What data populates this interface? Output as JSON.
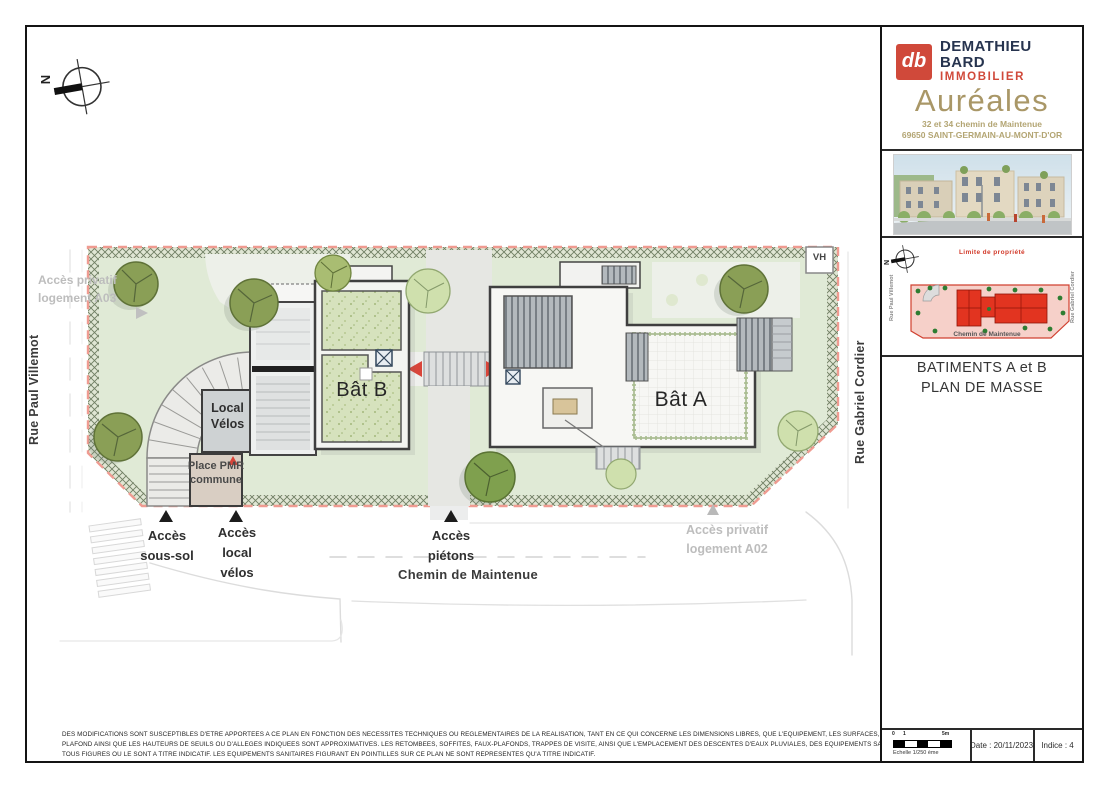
{
  "sidebar": {
    "brand": {
      "logo_glyph": "db",
      "line1": "DEMATHIEU",
      "line2": "BARD",
      "line3": "IMMOBILIER"
    },
    "project": {
      "name": "Auréales",
      "address1": "32 et 34 chemin de Maintenue",
      "address2": "69650 SAINT-GERMAIN-AU-MONT-D'OR"
    },
    "keymap": {
      "limit": "Limite de propriété",
      "north": "N",
      "street_left": "Rue Paul Villemot",
      "street_right": "Rue Gabriel Cordier",
      "street_bottom": "Chemin de Maintenue"
    },
    "title1": "BATIMENTS A et B",
    "title2": "PLAN DE MASSE",
    "footer": {
      "tick0": "0",
      "tick1": "1",
      "tick5": "5m",
      "scale": "Echelle 1/250 ème",
      "date": "Date : 20/11/2023",
      "indice": "Indice : 4"
    }
  },
  "plan": {
    "north": "N",
    "streets": {
      "left": "Rue Paul Villemot",
      "right": "Rue Gabriel Cordier",
      "bottom": "Chemin de Maintenue"
    },
    "buildings": {
      "bat_a": "Bât A",
      "bat_b": "Bât B"
    },
    "rooms": {
      "local_velos": "Local\nVélos",
      "place_pmr": "Place PMR\ncommune"
    },
    "markers": {
      "vh": "VH"
    },
    "access": {
      "sous_sol": "Accès\nsous-sol",
      "local_velos": "Accès\nlocal\nvélos",
      "pietons": "Accès\npiétons",
      "privatif_a02": "Accès privatif\nlogement A02",
      "privatif_a03": "Accès privatif\nlogement A03"
    }
  },
  "notes": {
    "line1": "DES MODIFICATIONS SONT SUSCEPTIBLES D'ETRE APPORTEES A CE PLAN EN FONCTION DES NECESSITES TECHNIQUES OU REGLEMENTAIRES DE LA REALISATION, TANT EN CE QUI CONCERNE LES DIMENSIONS LIBRES, QUE L'EQUIPEMENT, LES SURFACES, LES HAUTEURS SOUS",
    "line2": "PLAFOND AINSI QUE LES HAUTEURS DE SEUILS OU D'ALLEGES INDIQUEES SONT APPROXIMATIVES. LES RETOMBEES, SOFFITES, FAUX-PLAFONDS, TRAPPES DE VISITE, AINSI QUE L'EMPLACEMENT DES DESCENTES D'EAUX PLUVIALES, DES EQUIPEMENTS SANITAIRES NE SONT PAS",
    "line3": "TOUS FIGURES OU LE SONT A TITRE INDICATIF. LES EQUIPEMENTS SANITAIRES FIGURANT EN POINTILLES SUR CE PLAN NE SONT REPRESENTES QU'A TITRE INDICATIF."
  },
  "colors": {
    "brand_red": "#d0493a",
    "brand_navy": "#27344f",
    "gold": "#a99767",
    "plan_red": "#d9453a",
    "limit_dash_red": "#ef9b91",
    "lawn_green": "#e0ead6",
    "keymap_building_red": "#e23420",
    "keymap_site_pink": "#f6d0c9"
  }
}
